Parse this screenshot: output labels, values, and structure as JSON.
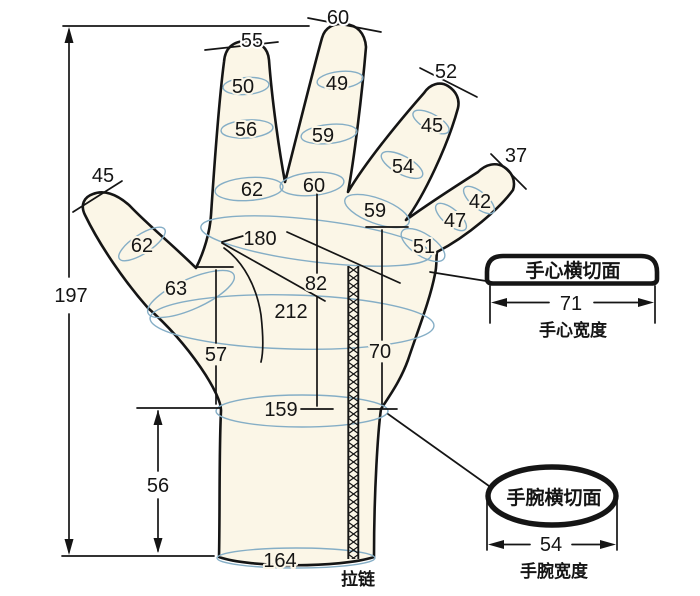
{
  "diagram_title": "glove-hand-measurement-diagram",
  "colors": {
    "hand_fill": "#FBF6E7",
    "outline": "#151515",
    "ring_line": "#85AEC6",
    "background": "#ffffff"
  },
  "measurements": {
    "total_length": "197",
    "cuff_height": "56",
    "cuff_bottom_width": "164",
    "wrist_line": "159",
    "palm_left_height": "57",
    "palm_right_height": "70",
    "palm_girth": "212",
    "knuckle_drop": "82",
    "knuckle_girth": "180"
  },
  "fingers": {
    "thumb": {
      "tip": "45",
      "rings": [
        "62",
        "63"
      ]
    },
    "index": {
      "tip": "55",
      "rings": [
        "50",
        "56",
        "62"
      ]
    },
    "middle": {
      "tip": "60",
      "rings": [
        "49",
        "59",
        "60"
      ]
    },
    "ring": {
      "tip": "52",
      "rings": [
        "45",
        "54",
        "59"
      ]
    },
    "pinky": {
      "tip": "37",
      "rings": [
        "42",
        "47",
        "51"
      ]
    }
  },
  "palm_section": {
    "title": "手心横切面",
    "width": "71",
    "caption": "手心宽度"
  },
  "wrist_section": {
    "title": "手腕横切面",
    "width": "54",
    "caption": "手腕宽度"
  },
  "zipper": {
    "label": "拉链"
  }
}
